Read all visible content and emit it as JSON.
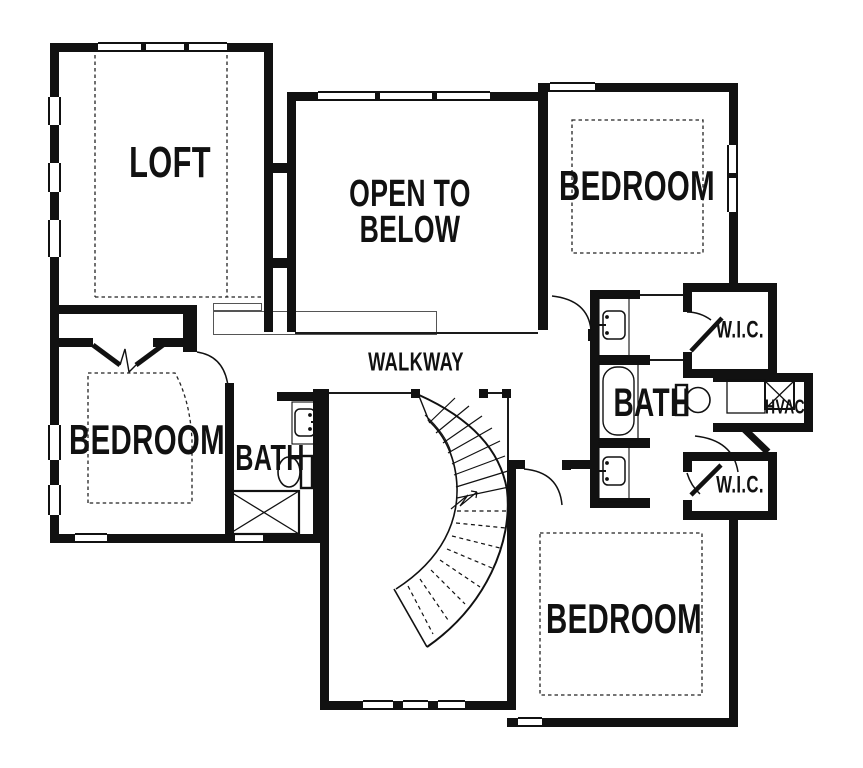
{
  "document": {
    "type": "floor-plan",
    "view": "upper-floor"
  },
  "colors": {
    "wall": "#111111",
    "background": "#ffffff",
    "dashed_line": "#222222"
  },
  "labels": {
    "loft": "LOFT",
    "open_to_below_line1": "OPEN TO",
    "open_to_below_line2": "BELOW",
    "walkway": "WALKWAY",
    "bedroom_top_right": "BEDROOM",
    "bedroom_left": "BEDROOM",
    "bedroom_bottom_right": "BEDROOM",
    "bath_left": "BATH",
    "bath_right": "BATH",
    "wic_top": "W.I.C.",
    "wic_bottom": "W.I.C.",
    "hvac": "HVAC"
  },
  "rooms": [
    {
      "name": "Loft"
    },
    {
      "name": "Open to Below"
    },
    {
      "name": "Walkway"
    },
    {
      "name": "Bedroom (top right)"
    },
    {
      "name": "Bedroom (left)"
    },
    {
      "name": "Bedroom (bottom right)"
    },
    {
      "name": "Bath (left)"
    },
    {
      "name": "Bath (right)"
    },
    {
      "name": "W.I.C. (top)"
    },
    {
      "name": "W.I.C. (bottom)"
    },
    {
      "name": "HVAC closet"
    }
  ],
  "fixtures": [
    "curved-staircase",
    "bathtub",
    "shower",
    "toilet",
    "toilet",
    "sink",
    "sink",
    "sink",
    "hvac-unit",
    "water-heater"
  ],
  "doors": [
    "double-door-bedroom-left",
    "bath-left-door",
    "bedroom-top-right-door",
    "bedroom-bottom-right-door",
    "wic-top-door",
    "wic-bottom-door",
    "hall-door"
  ],
  "windows_count": 14
}
